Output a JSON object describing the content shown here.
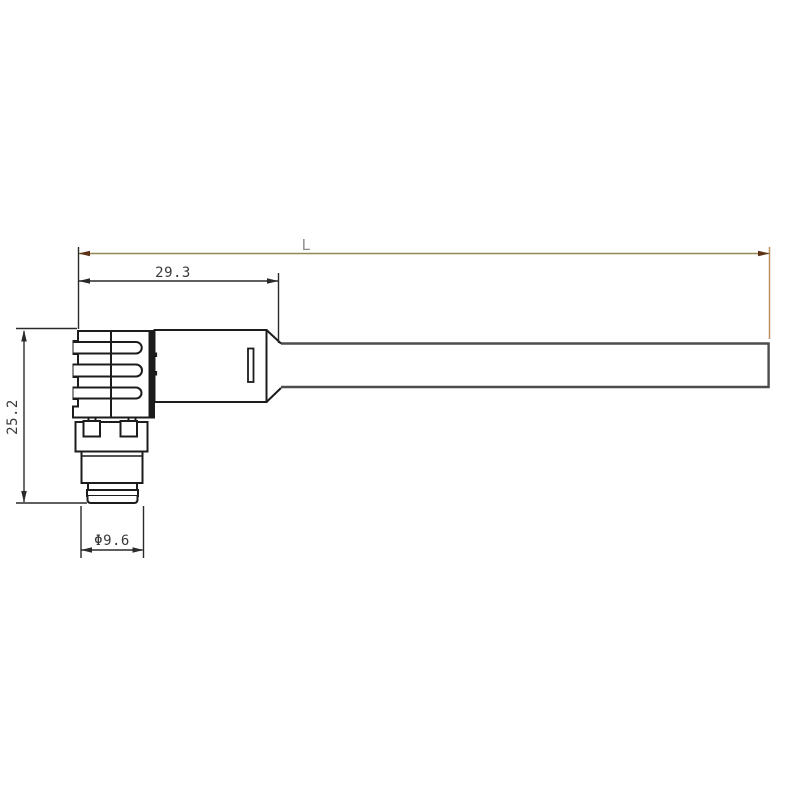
{
  "drawing": {
    "dimensions": {
      "overall_length": "L",
      "connector_length": "29.3",
      "connector_height": "25.2",
      "connector_diameter": "Φ9.6"
    }
  },
  "colors": {
    "background": "#ffffff",
    "part_outline": "#1c1c1c",
    "part_fill": "#ffffff",
    "cable_outline": "#4d4d4d",
    "dimension_line": "#2a2a2a",
    "dimension_text": "#3a3a3a",
    "overall_dim_line": "#8f8a55",
    "overall_dim_arrow": "#5c3317",
    "overall_dim_extension": "#b9905e",
    "overall_dim_text": "#8e8e8e"
  }
}
